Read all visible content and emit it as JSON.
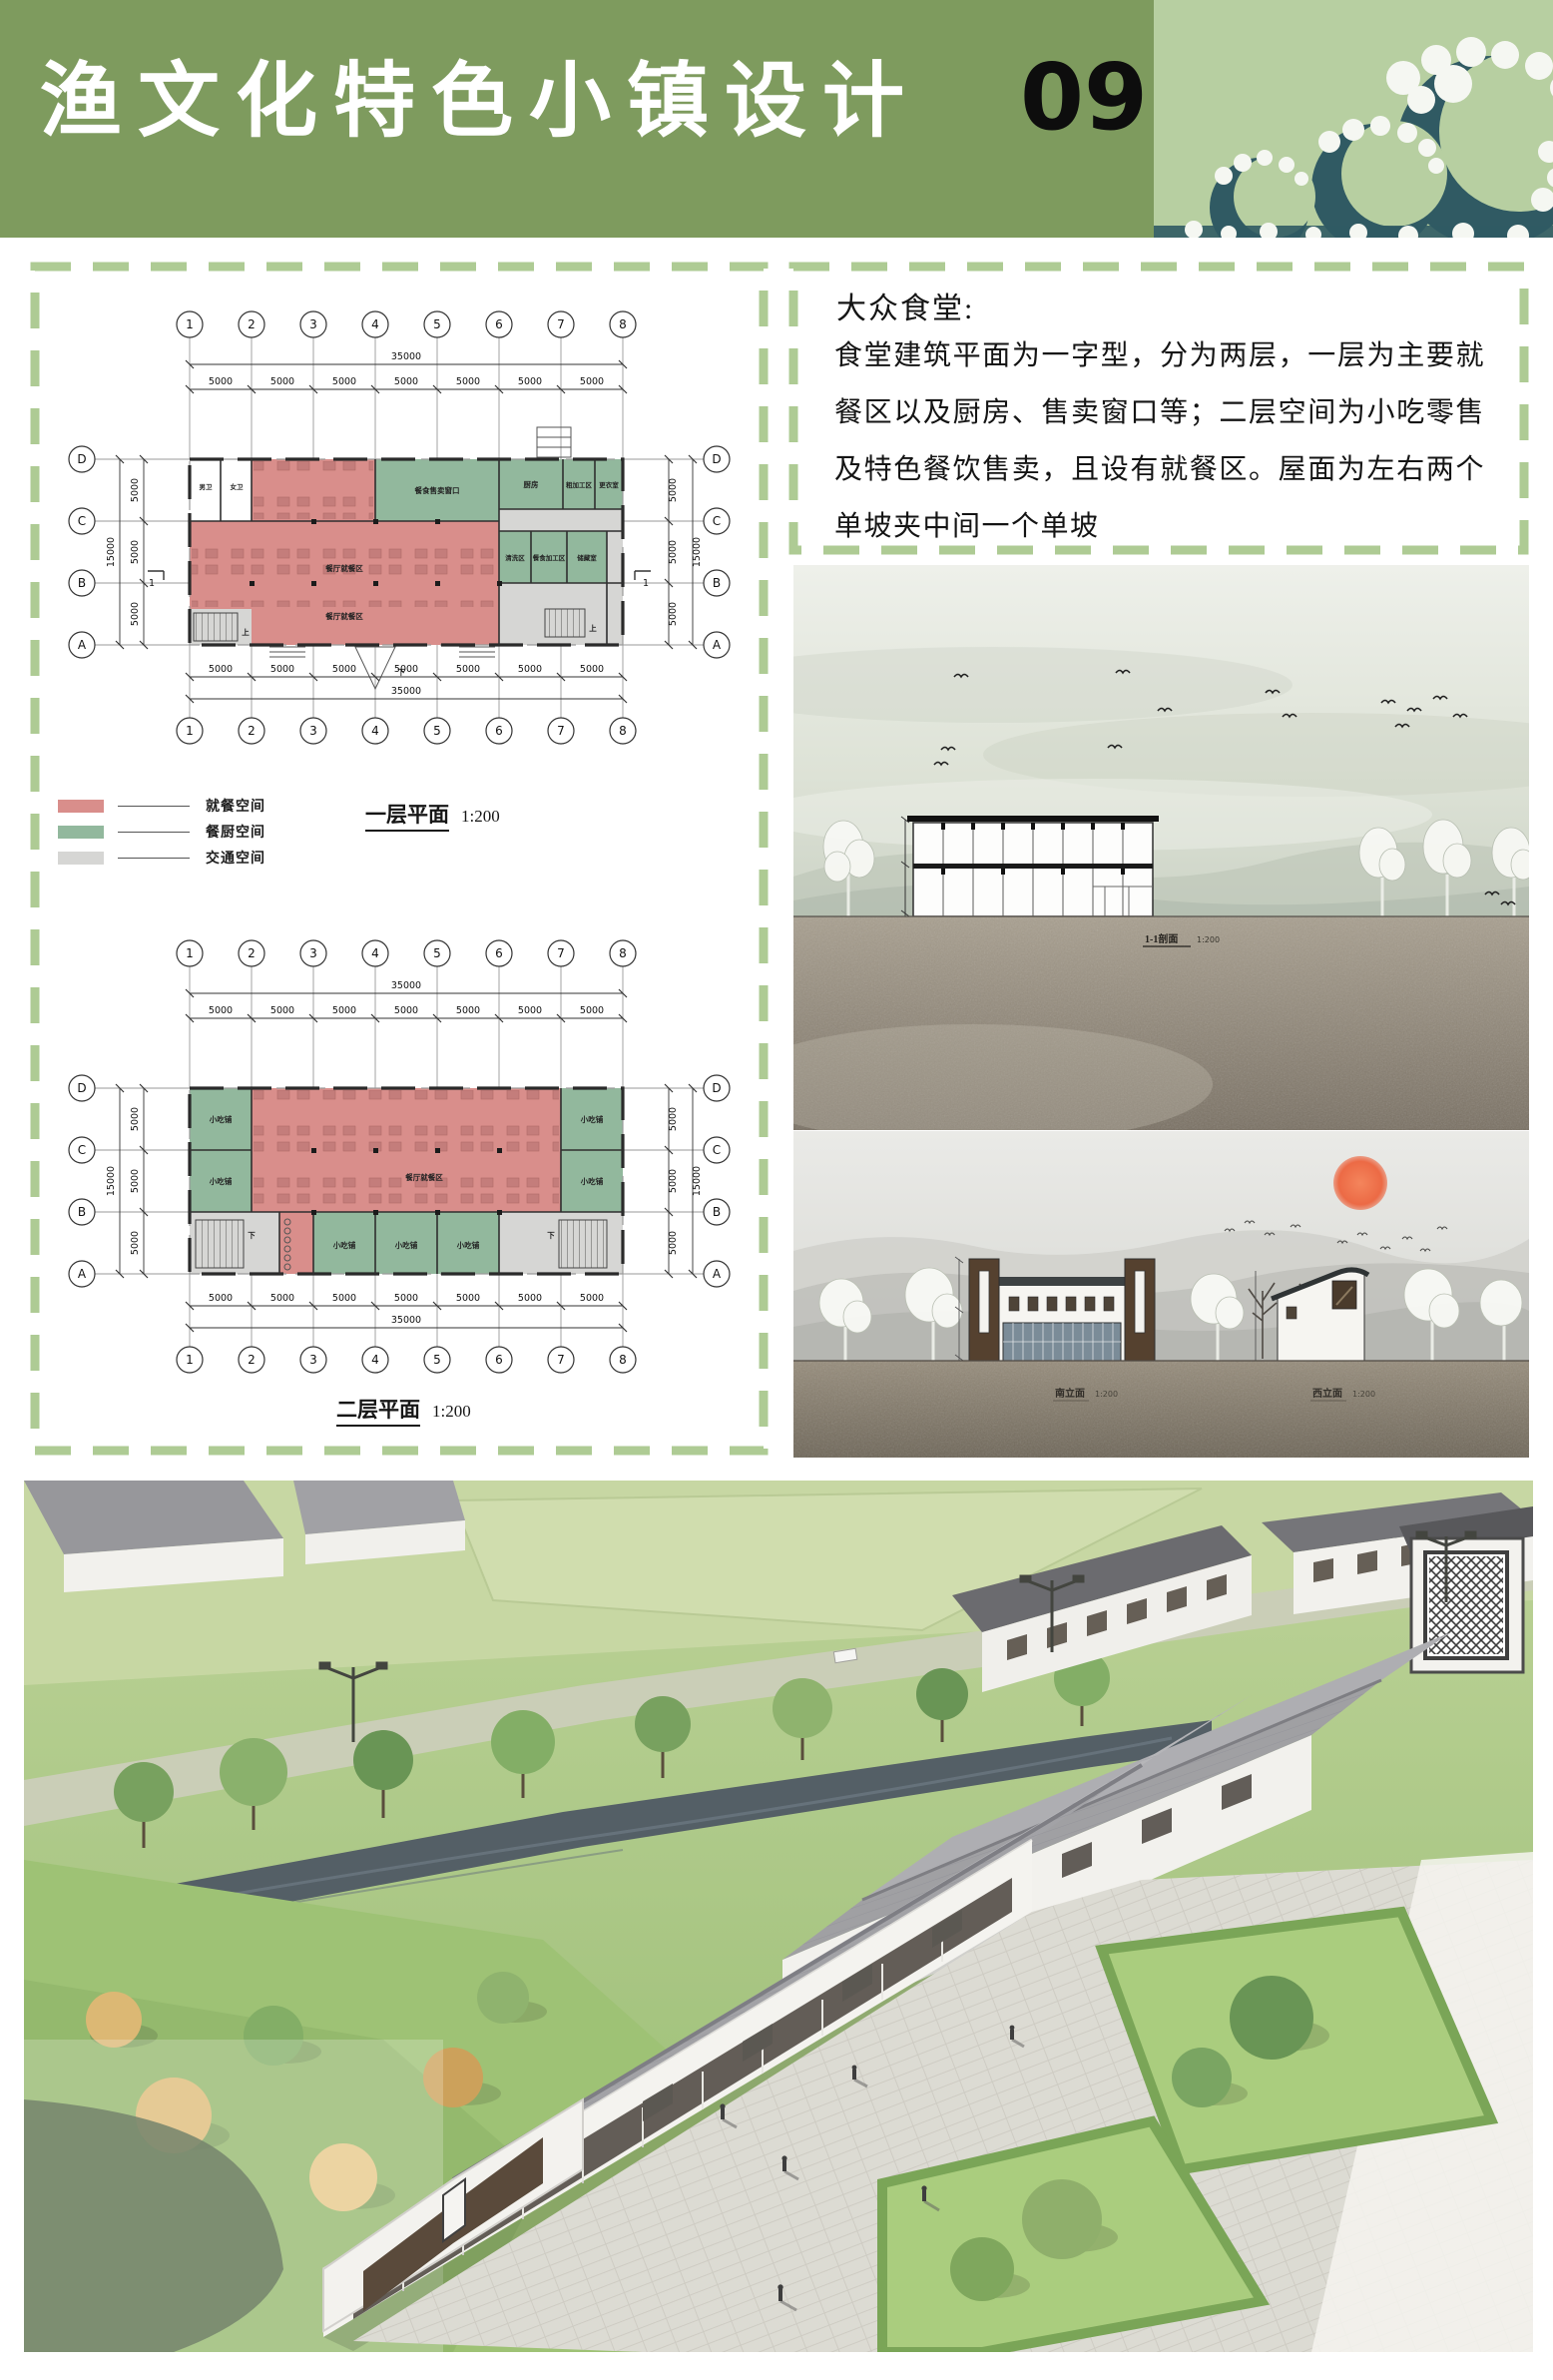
{
  "header": {
    "title": "渔文化特色小镇设计",
    "page_number": "09",
    "colors": {
      "band_green": "#7E9B5E",
      "band_light_green": "#B7CFA1",
      "wave_teal": "#305A63"
    }
  },
  "text_panel": {
    "title": "大众食堂:",
    "body": "食堂建筑平面为一字型，分为两层，一层为主要就餐区以及厨房、售卖窗口等；二层空间为小吃零售及特色餐饮售卖，且设有就餐区。屋面为左右两个单坡夹中间一个单坡"
  },
  "plans": {
    "grid": {
      "cols": [
        "1",
        "2",
        "3",
        "4",
        "5",
        "6",
        "7",
        "8"
      ],
      "rows": [
        "D",
        "C",
        "B",
        "A"
      ],
      "bay_mm": 5000,
      "bay_count": 7,
      "total_width_mm": 35000,
      "total_depth_mm": 15000
    },
    "dims": {
      "total_w": "35000",
      "bay": "5000",
      "total_h": "15000"
    },
    "p1": {
      "caption": "一层平面",
      "scale": "1:200",
      "section_mark": "1",
      "rooms": {
        "toilet_m": "男卫",
        "toilet_f": "女卫",
        "dining": "餐厅就餐区",
        "serving": "餐食售卖窗口",
        "kitchen": "厨房",
        "rough_prep": "粗加工区",
        "changing": "更衣室",
        "washing": "清洗区",
        "food_prep": "餐食加工区",
        "storage": "储藏室",
        "stair_up": "上",
        "stair_down": "下"
      }
    },
    "p2": {
      "caption": "二层平面",
      "scale": "1:200",
      "rooms": {
        "snack": "小吃铺",
        "dining": "餐厅就餐区",
        "stair_down": "下"
      }
    }
  },
  "legend": {
    "items": [
      {
        "label": "就餐空间",
        "color": "#D98E8B"
      },
      {
        "label": "餐厨空间",
        "color": "#92B89D"
      },
      {
        "label": "交通空间",
        "color": "#D6D6D4"
      }
    ]
  },
  "renders": {
    "section": {
      "caption": "1-1剖面",
      "scale": "1:200"
    },
    "elevation": {
      "south": "南立面",
      "west": "西立面",
      "scale": "1:200"
    }
  }
}
